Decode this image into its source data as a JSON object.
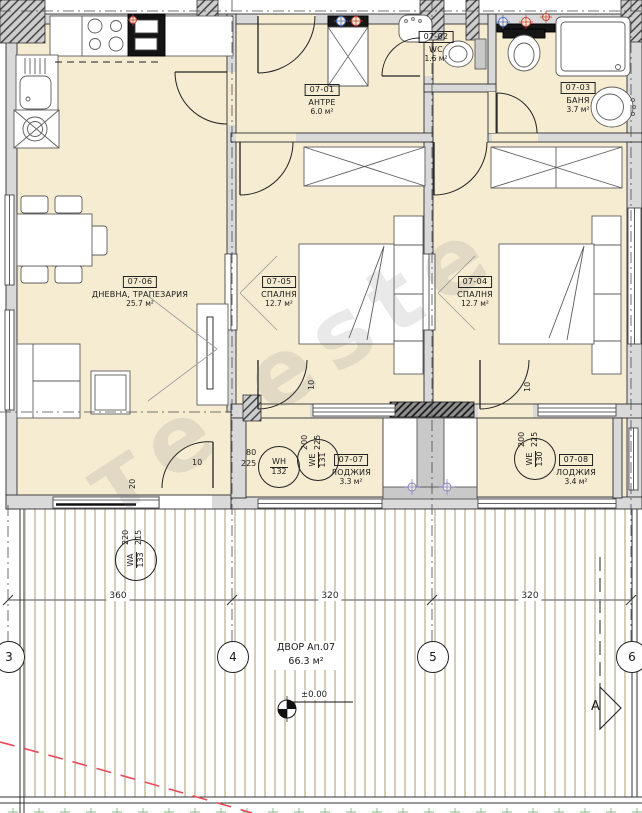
{
  "rooms": [
    {
      "id": "07-01",
      "name": "АНТРЕ",
      "area": "6.0 м²"
    },
    {
      "id": "07-02",
      "name": "WC",
      "area": "1.6 м²"
    },
    {
      "id": "07-03",
      "name": "БАНЯ",
      "area": "3.7 м²"
    },
    {
      "id": "07-04",
      "name": "СПАЛНЯ",
      "area": "12.7 м²"
    },
    {
      "id": "07-05",
      "name": "СПАЛНЯ",
      "area": "12.7 м²"
    },
    {
      "id": "07-06",
      "name": "ДНЕВНА, ТРАПЕЗАРИЯ",
      "area": "25.7 м²"
    },
    {
      "id": "07-07",
      "name": "ЛОДЖИЯ",
      "area": "3.3 м²"
    },
    {
      "id": "07-08",
      "name": "ЛОДЖИЯ",
      "area": "3.4 м²"
    }
  ],
  "yard": {
    "label": "ДВОР Ап.07",
    "area": "66.3 м²",
    "elevation": "±0.00"
  },
  "openings": [
    {
      "code": "WH",
      "num": "132",
      "w": "80",
      "h": "225"
    },
    {
      "code": "WE",
      "num": "131",
      "w": "200",
      "h": "225"
    },
    {
      "code": "WE",
      "num": "130",
      "w": "200",
      "h": "225"
    },
    {
      "code": "WA",
      "num": "133",
      "w": "220",
      "h": "215"
    }
  ],
  "grid": {
    "bubbles": [
      "3",
      "4",
      "5",
      "6"
    ],
    "section": "А",
    "dims": [
      "360",
      "320",
      "320"
    ]
  },
  "wall_dims": {
    "ten": "10",
    "twenty": "20"
  },
  "watermark": "те este",
  "colors": {
    "floor": "#f6ecd2",
    "wall": "#d9d9d9",
    "yard_hatch": "#a19060",
    "red_line": "#e84b57",
    "valve_blue": "#4a6fc4",
    "valve_red": "#c2403e",
    "sprinkler": "#8583cf"
  }
}
